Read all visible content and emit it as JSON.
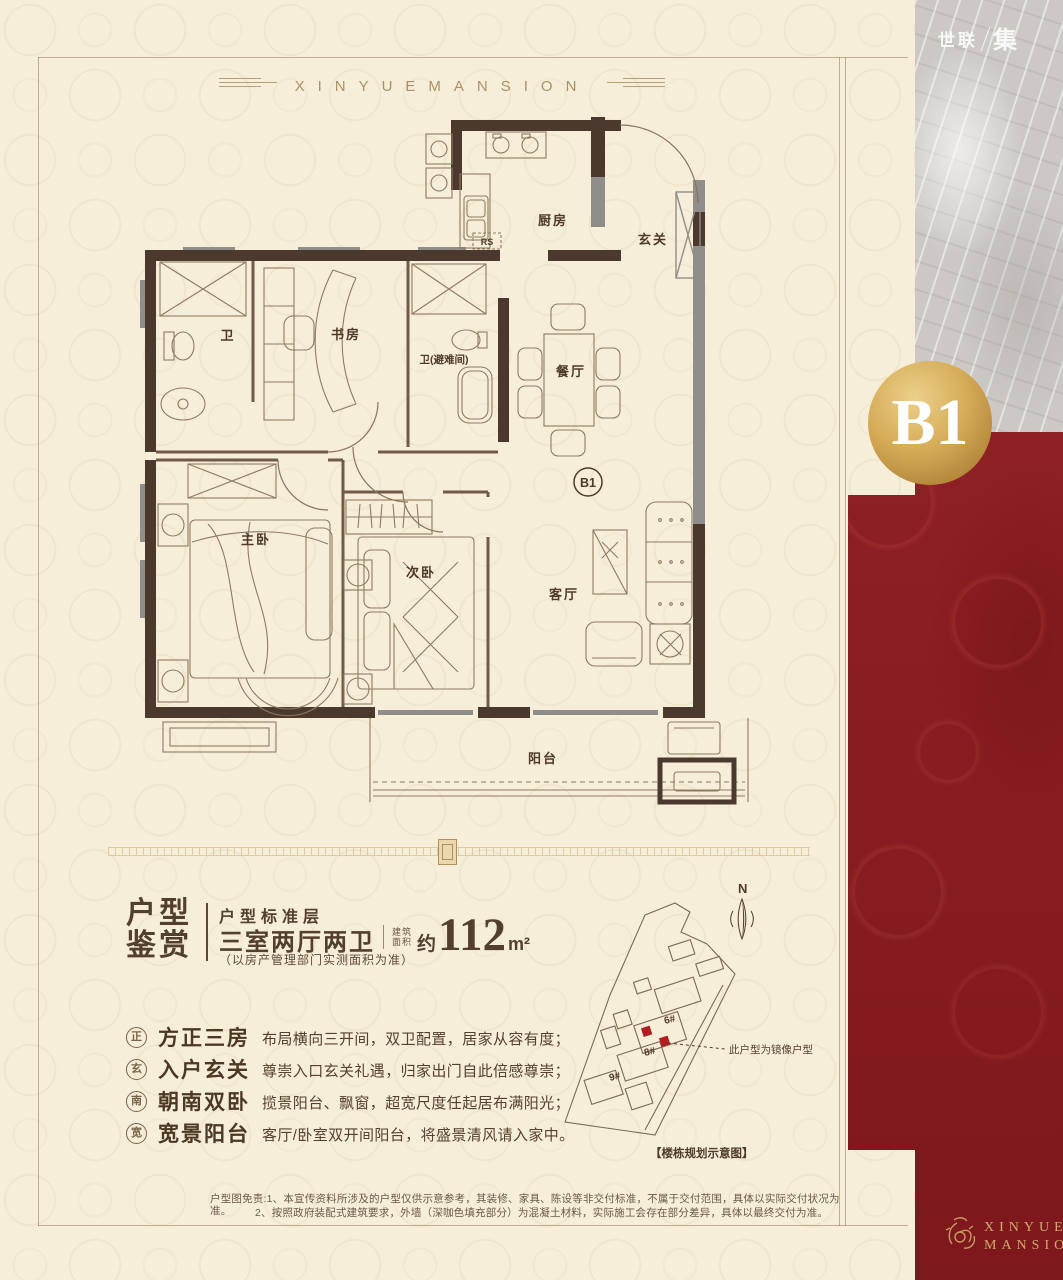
{
  "page": {
    "banner_text": "XINYUEMANSION",
    "corner_logo": {
      "left": "世联",
      "right": "集"
    },
    "badge_label": "B1",
    "footer_logo": {
      "line1": "XINYUE",
      "line2": "MANSION"
    }
  },
  "floorplan": {
    "unit_label": "B1",
    "fridge_label": "RS",
    "rooms": {
      "kitchen": "厨房",
      "foyer": "玄关",
      "bath1": "卫",
      "study": "书房",
      "bath2": "卫(避难间)",
      "dining": "餐厅",
      "master": "主卧",
      "second": "次卧",
      "living": "客厅",
      "balcony": "阳台"
    }
  },
  "info": {
    "title_line1": "户型",
    "title_line2": "鉴赏",
    "subtitle": "户型标准层",
    "layout": "三室两厅两卫",
    "area_label_top": "建筑",
    "area_label_bottom": "面积",
    "area_prefix": "约",
    "area_value": "112",
    "area_unit": "m²",
    "note": "（以房产管理部门实测面积为准）"
  },
  "features": [
    {
      "seal": "正",
      "title": "方正三房",
      "desc": "布局横向三开间，双卫配置，居家从容有度；"
    },
    {
      "seal": "玄",
      "title": "入户玄关",
      "desc": "尊崇入口玄关礼遇，归家出门自此倍感尊崇；"
    },
    {
      "seal": "南",
      "title": "朝南双卧",
      "desc": "揽景阳台、飘窗，超宽尺度任起居布满阳光；"
    },
    {
      "seal": "宽",
      "title": "宽景阳台",
      "desc": "客厅/卧室双开间阳台，将盛景清风请入家中。"
    }
  ],
  "siteplan": {
    "north_label": "N",
    "buildings": [
      "6#",
      "8#",
      "9#"
    ],
    "callout": "此户型为镜像户型",
    "caption": "【楼栋规划示意图】"
  },
  "disclaimer": {
    "line1": "户型图免责:1、本宣传资料所涉及的户型仅供示意参考，其装修、家具、陈设等非交付标准，不属于交付范围，具体以实际交付状况为准。",
    "line2": "2、按照政府装配式建筑要求，外墙（深咖色填充部分）为混凝土材料，实际施工会存在部分差异，具体以最终交付为准。"
  },
  "colors": {
    "background": "#f6eed9",
    "wall_dark": "#4a392c",
    "wall_gray": "#908e8a",
    "accent_red": "#b01e23",
    "panel_red": "#8a1d21",
    "gold": "#c79c4e",
    "text_dark": "#53402c"
  }
}
